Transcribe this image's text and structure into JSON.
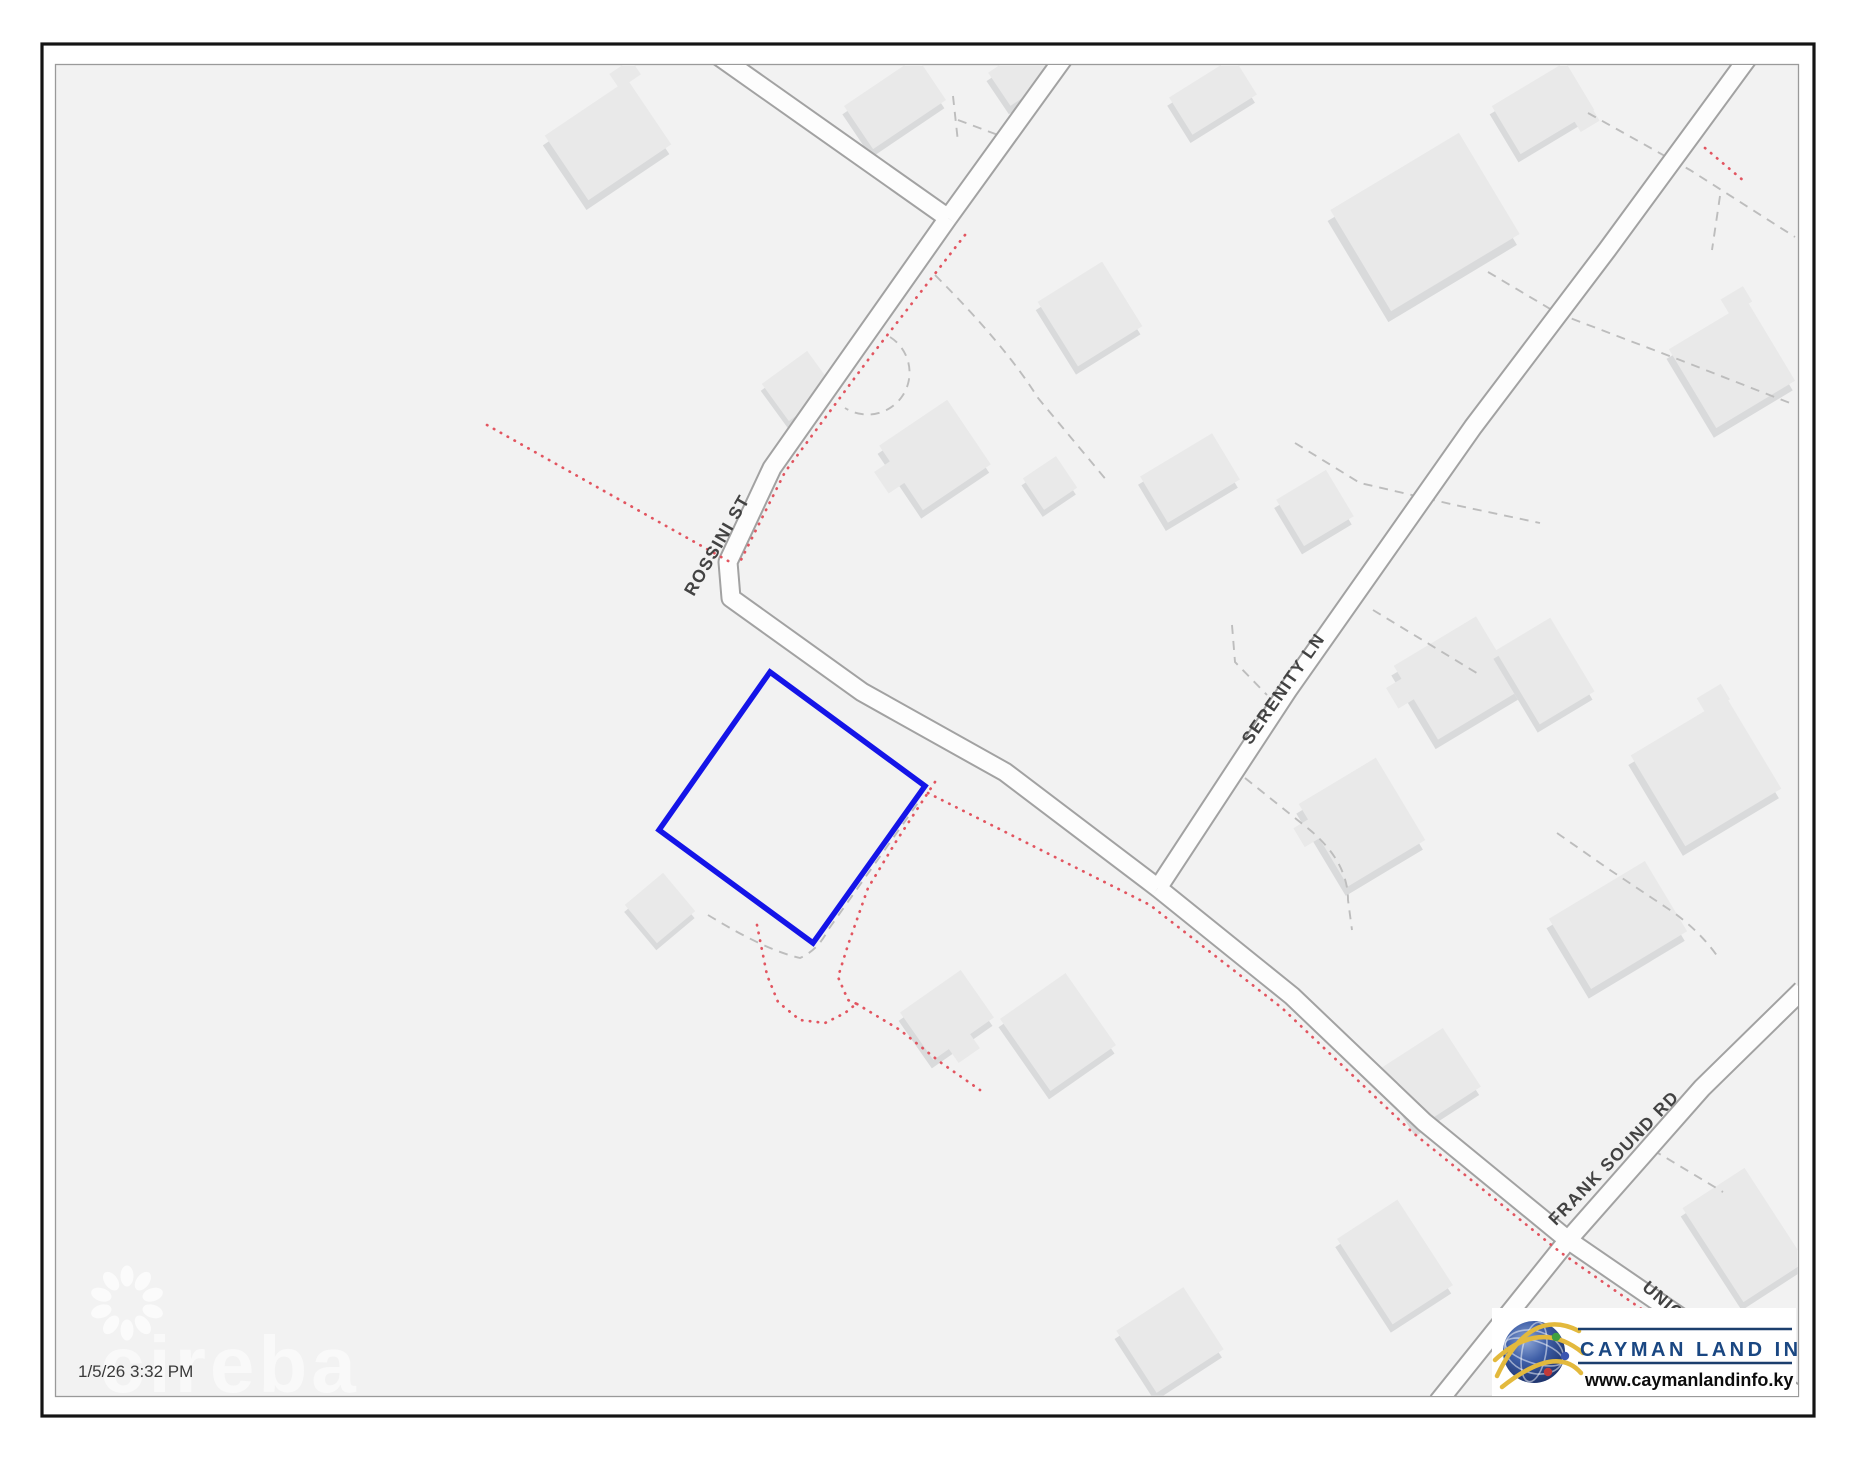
{
  "map": {
    "streets": [
      {
        "name": "ROSSINI ST"
      },
      {
        "name": "SERENITY LN"
      },
      {
        "name": "FRANK SOUND RD"
      },
      {
        "name": "UNION ST"
      }
    ],
    "parcel_highlight_color": "#1414e8",
    "boundary_dot_color": "#e25560",
    "road_casing_color": "#a2a2a2",
    "timestamp": "1/5/26 3:32 PM",
    "watermark_text": "cireba"
  },
  "logo": {
    "title": "CAYMAN LAND INFO",
    "website": "www.caymanlandinfo.ky",
    "accent_color": "#1a4782"
  }
}
